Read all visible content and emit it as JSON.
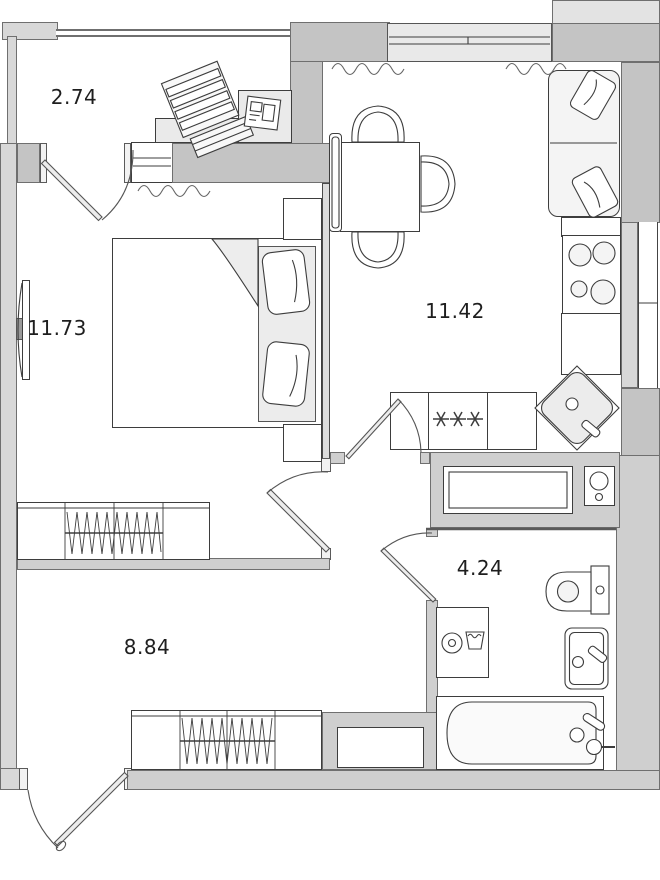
{
  "rooms": [
    {
      "name": "loggia",
      "area": "2.74"
    },
    {
      "name": "bedroom",
      "area": "11.73"
    },
    {
      "name": "kitchen-living-room",
      "area": "11.42"
    },
    {
      "name": "bathroom",
      "area": "4.24"
    },
    {
      "name": "hallway",
      "area": "8.84"
    }
  ],
  "fridge_marking": "✳✳✳",
  "colors": {
    "wall_dark": "#c4c4c4",
    "wall_medium": "#cfcfcf",
    "wall_light": "#d8d8d8",
    "line": "#3d3d3d",
    "floor": "#ffffff",
    "upholstery": "#ececec"
  },
  "fixtures": [
    "drying-rack",
    "desk",
    "tv",
    "double-bed",
    "nightstand",
    "wardrobe",
    "dining-table",
    "chair",
    "corner-sofa",
    "radiator",
    "window",
    "cooktop",
    "corner-sink",
    "refrigerator-freezer",
    "ventilation-duct",
    "water-heater",
    "toilet",
    "washbasin",
    "washing-machine",
    "bathtub",
    "entrance-door"
  ]
}
